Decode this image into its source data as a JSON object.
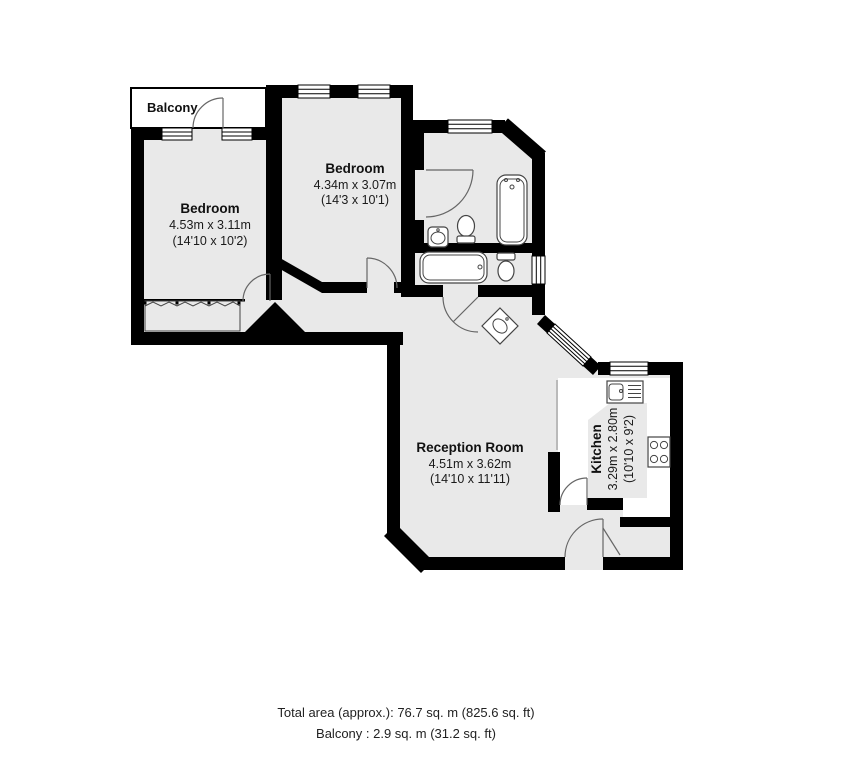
{
  "plan": {
    "balcony_label": "Balcony",
    "bedroom1": {
      "name": "Bedroom",
      "metric": "4.53m x 3.11m",
      "imperial": "(14'10 x 10'2)"
    },
    "bedroom2": {
      "name": "Bedroom",
      "metric": "4.34m x 3.07m",
      "imperial": "(14'3 x 10'1)"
    },
    "reception": {
      "name": "Reception Room",
      "metric": "4.51m x 3.62m",
      "imperial": "(14'10 x 11'11)"
    },
    "kitchen": {
      "name": "Kitchen",
      "metric": "3.29m x 2.80m",
      "imperial": "(10'10 x 9'2)"
    }
  },
  "footer": {
    "total_area": "Total area (approx.): 76.7 sq. m (825.6 sq. ft)",
    "balcony_area": "Balcony : 2.9 sq. m (31.2 sq. ft)"
  },
  "colors": {
    "wall": "#000000",
    "room_fill": "#e9e9e9",
    "background": "#ffffff"
  }
}
